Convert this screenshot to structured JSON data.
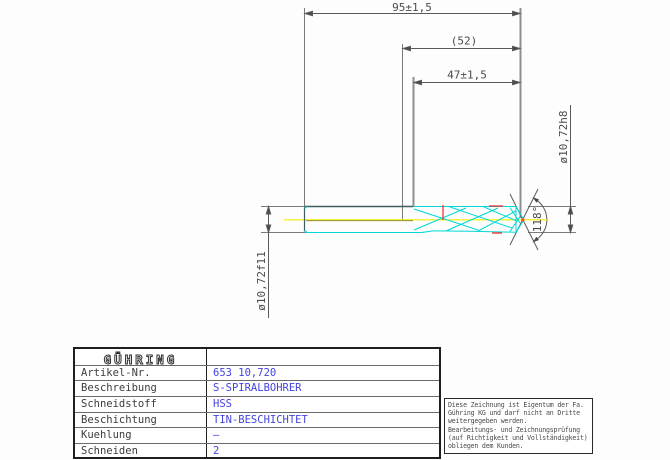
{
  "dimensions": {
    "overall_length": "95±1,5",
    "reference_length": "(52)",
    "flute_length": "47±1,5",
    "shank_diameter": "ø10,72h8",
    "front_diameter": "ø10,72f11",
    "point_angle": "118°"
  },
  "title_block": {
    "logo": "GÜHRING",
    "rows": [
      {
        "label": "Artikel-Nr.",
        "value": "653 10,720"
      },
      {
        "label": "Beschreibung",
        "value": "S-SPIRALBOHRER"
      },
      {
        "label": "Schneidstoff",
        "value": "HSS"
      },
      {
        "label": "Beschichtung",
        "value": "TIN-BESCHICHTET"
      },
      {
        "label": "Kuehlung",
        "value": "–"
      },
      {
        "label": "Schneiden",
        "value": "2"
      }
    ]
  },
  "disclaimer": {
    "lines": [
      "Diese Zeichnung ist Eigentum der Fa.",
      "Gühring KG und darf nicht an Dritte",
      "weitergegeben werden.",
      "Bearbeitungs- und Zeichnungsprüfung",
      "(auf Richtigkeit und Vollständigkeit)",
      "obliegen dem Kunden."
    ]
  },
  "colors": {
    "outline_cyan": "#00d8d8",
    "centerline_yellow": "#f0f000",
    "mark_red": "#ff2020",
    "value_blue": "#4343e0",
    "dim_gray": "#7a7a7a"
  }
}
